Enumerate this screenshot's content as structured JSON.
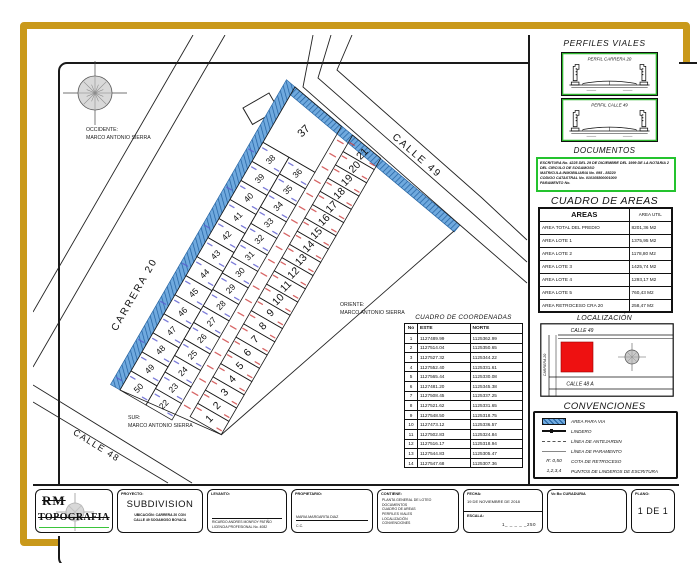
{
  "colors": {
    "gold": "#C9991B",
    "hatch_fill": "#6FA9DE",
    "hatch_line": "#205F9E",
    "dim_blue": "#5B5BCF",
    "dim_red": "#CE4040",
    "green_box": "#24C32E",
    "red_loc": "#EE1111"
  },
  "plan": {
    "labels": {
      "occidente": [
        "OCCIDENTE:",
        "MARCO ANTONIO SIERRA"
      ],
      "oriente": [
        "ORIENTE:",
        "MARCO ANTONIO SIERRA"
      ],
      "sur": [
        "SUR:",
        "MARCO ANTONIO SIERRA"
      ],
      "carrera20": "CARRERA 20",
      "calle49": "CALLE 49",
      "calle48": "CALLE 48"
    },
    "lots_col1": [
      "50",
      "49",
      "48",
      "47",
      "46",
      "45",
      "44",
      "43",
      "42",
      "41",
      "40",
      "39",
      "38"
    ],
    "lots_col2": [
      "22",
      "23",
      "24",
      "25",
      "26",
      "27",
      "28",
      "29",
      "30",
      "31",
      "32",
      "33",
      "34",
      "35",
      "36"
    ],
    "lot_top": "37",
    "lots_col3": [
      "1",
      "2",
      "3",
      "4",
      "5",
      "6",
      "7",
      "8",
      "9",
      "10",
      "11",
      "12",
      "13",
      "14",
      "15",
      "16",
      "17",
      "18",
      "19",
      "20",
      "21"
    ]
  },
  "coord_table": {
    "title": "CUADRO DE COORDENADAS",
    "headers": [
      "No",
      "ESTE",
      "NORTE"
    ],
    "rows": [
      [
        "1",
        "1127489.99",
        "1125362.99"
      ],
      [
        "2",
        "1127514.04",
        "1125350.65"
      ],
      [
        "3",
        "1127527.32",
        "1125344.22"
      ],
      [
        "4",
        "1127552.40",
        "1125331.61"
      ],
      [
        "5",
        "1127565.44",
        "1125330.08"
      ],
      [
        "6",
        "1127481.20",
        "1125345.38"
      ],
      [
        "7",
        "1127508.45",
        "1125337.25"
      ],
      [
        "8",
        "1127521.62",
        "1125331.65"
      ],
      [
        "9",
        "1127548.50",
        "1125318.75"
      ],
      [
        "10",
        "1127473.12",
        "1125336.57"
      ],
      [
        "11",
        "1127502.83",
        "1125324.84"
      ],
      [
        "12",
        "1127516.17",
        "1125318.94"
      ],
      [
        "13",
        "1127544.83",
        "1125305.47"
      ],
      [
        "14",
        "1127547.68",
        "1125307.36"
      ]
    ]
  },
  "panel": {
    "perfiles": {
      "title": "PERFILES VIALES",
      "profiles": [
        {
          "label": "PERFIL CARRERA 20"
        },
        {
          "label": "PERFIL CALLE 49"
        }
      ]
    },
    "documentos": {
      "title": "DOCUMENTOS",
      "lines": [
        "ESCRITURA No. 4225 DEL 29 DE DICIEMBRE DEL 1999 DE LA NOTARIA 2 DEL CIRCULO DE SOGAMOSO",
        "MATRICULA INMOBILIARIA No. 095 - 88220",
        "CODIGO CATASTRAL No. 010105800001000",
        "PARAMENTO No."
      ]
    },
    "areas": {
      "title": "CUADRO DE AREAS",
      "col1_header": "AREAS",
      "col2_header": "AREA UTIL",
      "rows": [
        [
          "AREA TOTAL DEL PREDIO",
          "8201,36  M2"
        ],
        [
          "AREA LOTE 1",
          "1375,95 M2"
        ],
        [
          "AREA LOTE 2",
          "1178,80 M2"
        ],
        [
          "AREA LOTE 3",
          "1425,74 M2"
        ],
        [
          "AREA LOTE 4",
          "1293,17 M2"
        ],
        [
          "AREA LOTE 5",
          "760,43  M2"
        ],
        [
          "AREA RETROCESO CRA 20",
          "258,47  M2"
        ]
      ]
    },
    "localizacion": {
      "title": "LOCALIZACIÓN",
      "calle49": "CALLE 49",
      "carrera20": "CARRERA 20",
      "calle48a": "CALLE 48  A"
    },
    "convenciones": {
      "title": "CONVENCIONES",
      "items": [
        {
          "symbol": "hatch",
          "label": "AREA PARA VIA"
        },
        {
          "symbol": "lindero",
          "label": "LINDERO"
        },
        {
          "symbol": "antejardin",
          "label": "LÍNEA DE ANTEJARDIN"
        },
        {
          "symbol": "paramento",
          "label": "LÍNEA DE PARAMENTO"
        },
        {
          "symbol": "R: 0,50",
          "label": "COTA DE RETROCESO"
        },
        {
          "symbol": "1,2,3,4",
          "label": "PUNTOS DE LINDEROS DE ESCRITURA"
        }
      ]
    }
  },
  "title_block": {
    "logo_rm": "RM",
    "logo_name": "TOPOGRAFIA",
    "proyecto_label": "PROYECTO:",
    "proyecto_value": "SUBDIVISION",
    "ubicacion_lines": [
      "UBICACIÓN: CARRERA 20  CON",
      "CALLE 49 SOGAMOSO BOYACA"
    ],
    "levanto_label": "LEVANTO:",
    "levanto_lines": [
      "RICARDO ANDRES MONROY PATIÑO",
      "LICENCIA PROFESIONAL  No. 4082"
    ],
    "propietario_label": "PROPIETARIO:",
    "propietario_name": "MARIA MARGARITA DIAZ",
    "propietario_cc": "C.C.",
    "contiene_label": "CONTIENE:",
    "contiene_lines": [
      "PLANTA GENERAL DE LOTEO",
      "DOCUMENTOS",
      "CUADRO DE AREAS",
      "PERFILES VIALES",
      "LOCALIZACIÓN",
      "CONVENCIONES"
    ],
    "fecha_label": "FECHA:",
    "fecha_value": "19 DE NOVIEMBRE  DE 2018",
    "escala_label": "ESCALA:",
    "escala_value": "1_ _ _ _ _250",
    "vobo_label": "Vo Bo CURADURIA",
    "plano_label": "PLANO:",
    "plano_value": "1 DE 1"
  }
}
